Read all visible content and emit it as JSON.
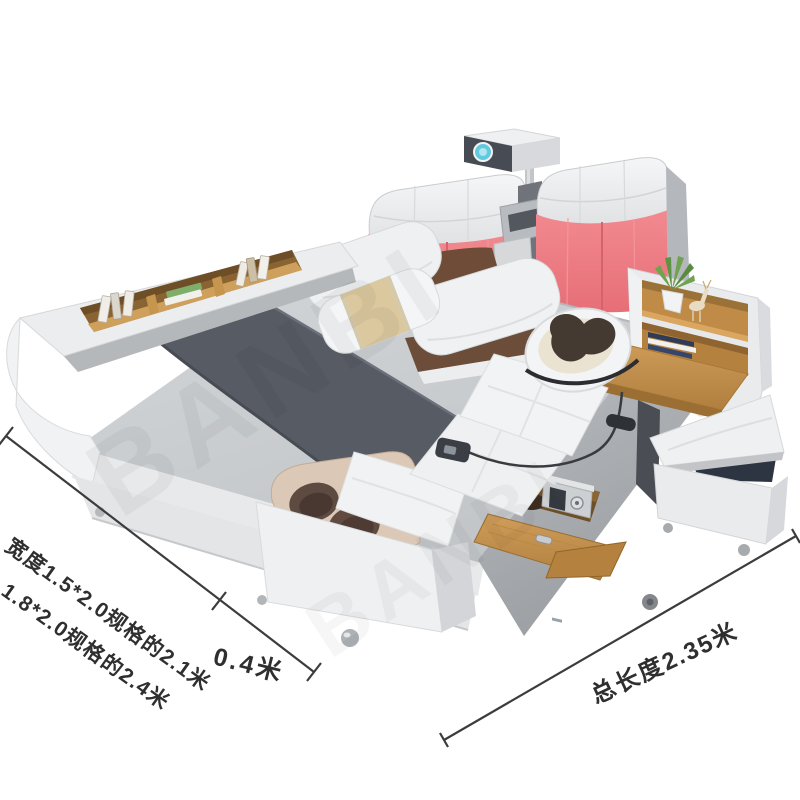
{
  "scene": {
    "description": "smart multifunctional storage bed product photo, isometric view",
    "objects": [
      "projector",
      "headboard-cushions",
      "speaker-console",
      "pillows",
      "bookshelf-side-rail",
      "mattress",
      "bed-runner",
      "massage-lounger",
      "neck-massager",
      "remote-control",
      "foot-massager",
      "storage-drawer",
      "safe-box",
      "nightstand-shelf",
      "potted-plant",
      "deer-figurine",
      "storage-ottoman",
      "chrome-feet"
    ]
  },
  "annotations": {
    "width_line1": "宽度1.5*2.0规格的2.1米",
    "width_line2": "1.8*2.0规格的2.4米",
    "foot_extension": "0.4米",
    "total_length": "总长度2.35米"
  },
  "watermark": {
    "text": "BANBI"
  },
  "colors": {
    "background": "#ffffff",
    "coral_headboard": "#ee7d83",
    "wood": "#c08b47",
    "runner_dark_gray": "#565b64",
    "mattress_gray": "#cbcfd2",
    "frame_white": "#eceeef",
    "dimension_line": "#3c3c3c",
    "massager_pad_brown": "#453a31",
    "foot_massager_beige": "#dcc8b6",
    "ottoman_interior_navy": "#2d3543",
    "projector_lens_cyan": "#62c9de",
    "plant_green": "#6fa34f",
    "pillow_stripe_beige": "#dbc89e"
  }
}
